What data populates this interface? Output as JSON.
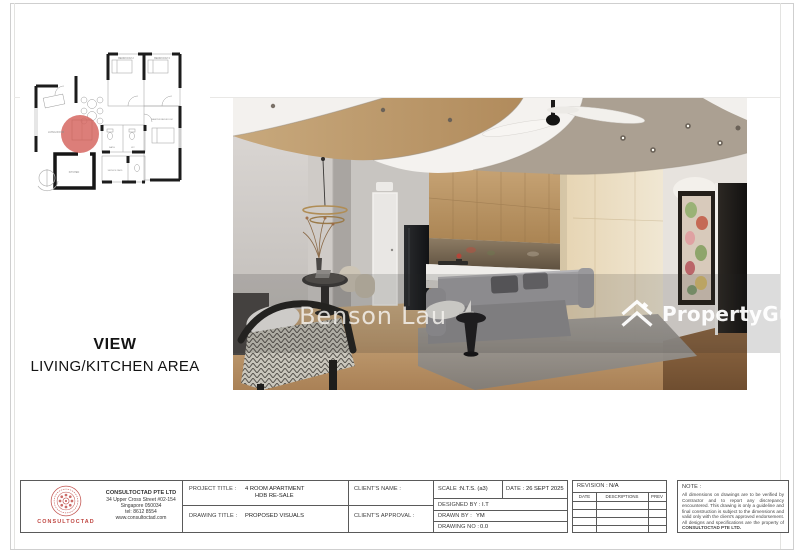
{
  "colors": {
    "highlight_circle": "#d4625c",
    "logo_red": "#bf4540",
    "wood": "#c19264",
    "watermark_band": "rgba(40,40,40,0.16)"
  },
  "floorplan": {
    "labels": {
      "living": "LIVING ROOM",
      "bedroom2": "BEDROOM 2",
      "bedroom3": "BEDROOM 3",
      "master": "MASTER BEDROOM",
      "kitchen": "KITCHEN",
      "bath": "BATH",
      "wc": "WC",
      "service": "SERVICE YARD"
    }
  },
  "view_label": {
    "title": "VIEW",
    "subtitle": "LIVING/KITCHEN AREA"
  },
  "watermarks": {
    "center": "Benson Lau",
    "brand": "PropertyGuru"
  },
  "title_block": {
    "company": {
      "brand": "CONSULTOCTAD",
      "name": "CONSULTOCTAD PTE LTD",
      "address_line1": "34 Upper Cross Street #02-154",
      "address_line2": "Singapore 050034",
      "tel": "tel: 8612 8554",
      "website": "www.consultoctad.com"
    },
    "project": {
      "label": "PROJECT TITLE :",
      "line1": "4 ROOM APARTMENT",
      "line2": "HDB RE-SALE"
    },
    "drawing": {
      "label": "DRAWING TITLE :",
      "value": "PROPOSED VISUALS"
    },
    "client_name_label": "CLIENT'S NAME :",
    "client_approval_label": "CLIENT'S APPROVAL :",
    "scale": {
      "label": "SCALE :",
      "value": "N.T.S. (a3)"
    },
    "date": {
      "label": "DATE :",
      "value": "26 SEPT 2025"
    },
    "designed_by": {
      "label": "DESIGNED BY :",
      "value": "I.T"
    },
    "drawn_by": {
      "label": "DRAWN BY :",
      "value": "YM"
    },
    "drawing_no": {
      "label": "DRAWING NO :",
      "value": "0.0"
    },
    "revision": {
      "label": "REVISION :",
      "value": "N/A",
      "columns": [
        "DATE",
        "DESCRIPTIONS",
        "PREV"
      ]
    },
    "note": {
      "label": "NOTE :",
      "body": "All dimensions on drawings are to be verified by Contractor and to report any discrepancy encountered. This drawing is only a guideline and final construction is subject to the dimensions and valid only with the client's approved endorsement. All designs and specifications are the property of",
      "company": "CONSULTOCTAD PTE LTD."
    }
  }
}
